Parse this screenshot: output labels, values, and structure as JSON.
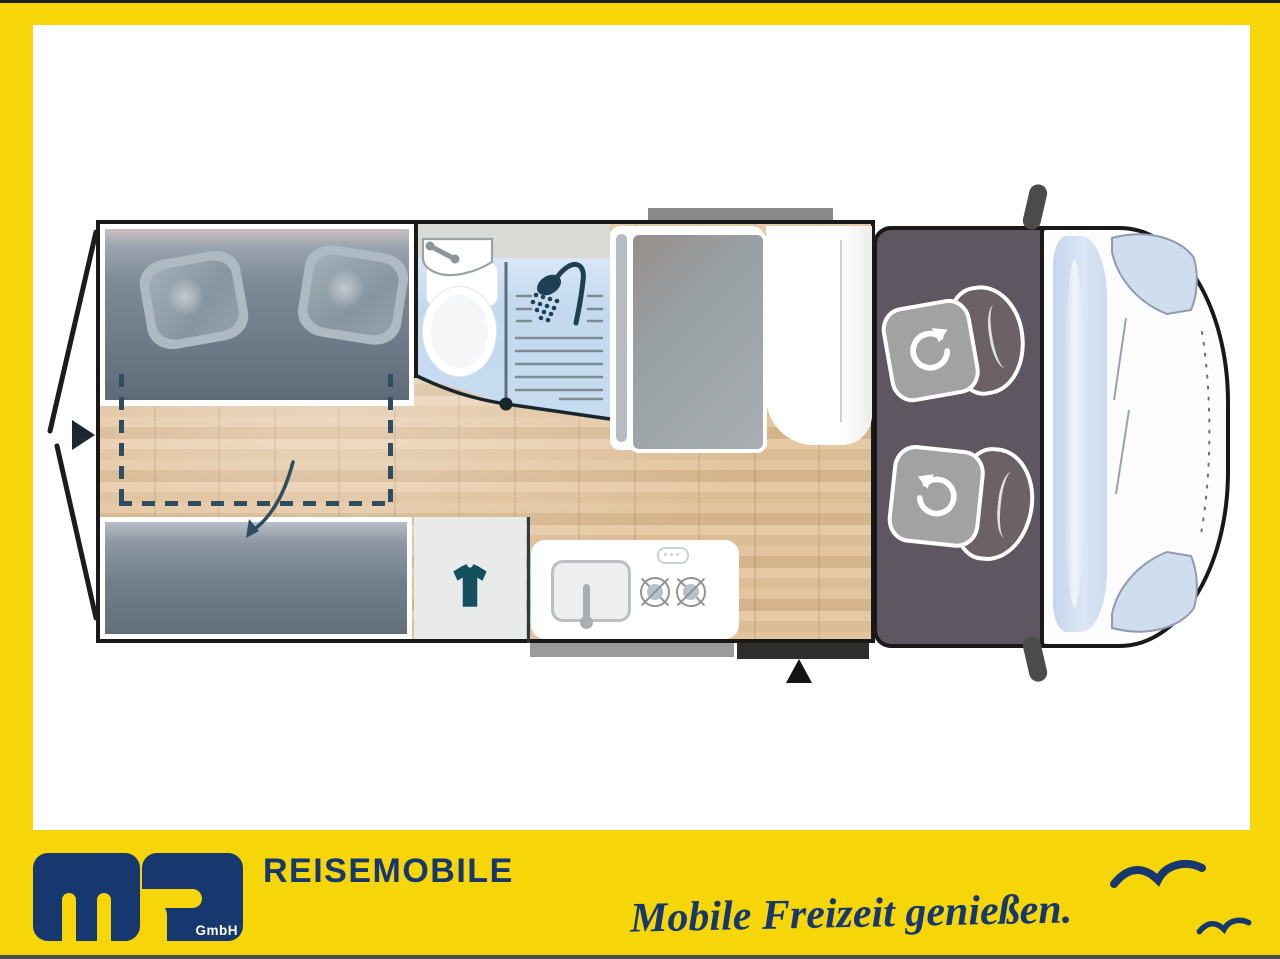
{
  "frame": {
    "border_yellow": "#F6D608",
    "top_line": "#1E1E1E",
    "bottom_line": "#4F4F4F",
    "paper": "#FFFFFF"
  },
  "branding": {
    "logo_letters": "ms",
    "company_suffix": "GmbH",
    "wordmark": "REISEMOBILE",
    "slogan": "Mobile Freizeit genießen.",
    "navy": "#17386E",
    "birds": [
      "seagull-large",
      "seagull-small"
    ]
  },
  "floorplan": {
    "view": "camper-van top view floor plan",
    "areas": {
      "rear_bed": "rear transverse double bed with two pillows",
      "bed_extension": "fold-out bed extension marked by dashed outline and arrow",
      "bench_bed": "lower single bed / bench",
      "clothes_cabinet": "cabinet with t-shirt symbol",
      "kitchen": "kitchen block with sink and 2-burner hob",
      "bathroom": "wet room with corner washbasin, toilet and shower",
      "fridge": "refrigerator unit",
      "tall_wardrobe": "tall wardrobe beside entry",
      "cab": "driver cab with two swivel seats (rotate arrows)",
      "entry_step": "sliding-door entry step with position arrow",
      "rear_doors": "open rear doors with access arrow"
    },
    "colors": {
      "wood_floor": "#E0C09C",
      "mattress": "#75808D",
      "bathroom_floor": "#C7DCF0",
      "cab_floor": "#5E5660",
      "wall": "#191919",
      "accent_navy": "#2E4D60",
      "step_gray": "#9B9B9B",
      "step_dark": "#2F2E2D"
    }
  }
}
